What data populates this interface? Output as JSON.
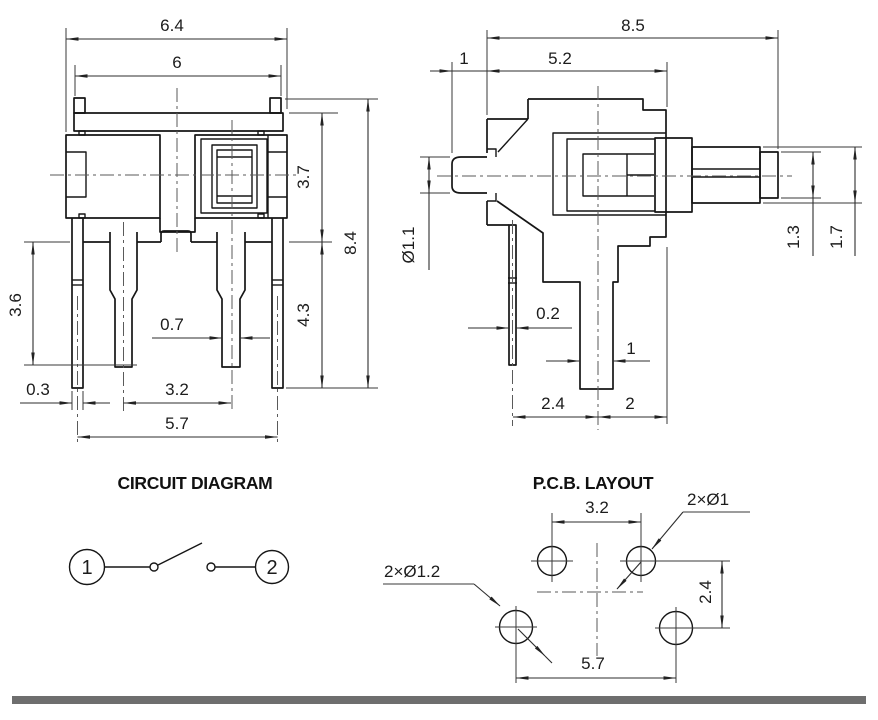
{
  "front_view": {
    "dim_width_flange": "6.4",
    "dim_width_body": "6",
    "dim_height_body": "3.7",
    "dim_height_pins": "4.3",
    "dim_height_overall": "8.4",
    "dim_pin_length": "3.6",
    "dim_pin_thickness": "0.3",
    "dim_pin_pitch": "3.2",
    "dim_pin_span": "5.7",
    "dim_pin_width": "0.7"
  },
  "side_view": {
    "dim_depth_overall": "8.5",
    "dim_actuator_protrusion": "1",
    "dim_body_depth": "5.2",
    "dim_actuator_diameter": "Ø1.1",
    "dim_pin_thickness": "0.2",
    "dim_pin_width": "1",
    "dim_pin_offset_rear": "2.4",
    "dim_pin_offset_front": "2",
    "dim_plunger_tip_height": "1.3",
    "dim_plunger_height": "1.7"
  },
  "circuit_diagram": {
    "title": "CIRCUIT DIAGRAM",
    "terminal_1": "1",
    "terminal_2": "2"
  },
  "pcb_layout": {
    "title": "P.C.B. LAYOUT",
    "dim_hole_pitch_top": "3.2",
    "dim_hole_pitch_bottom": "5.7",
    "dim_row_pitch": "2.4",
    "label_small_holes": "2×Ø1",
    "label_large_holes": "2×Ø1.2"
  }
}
